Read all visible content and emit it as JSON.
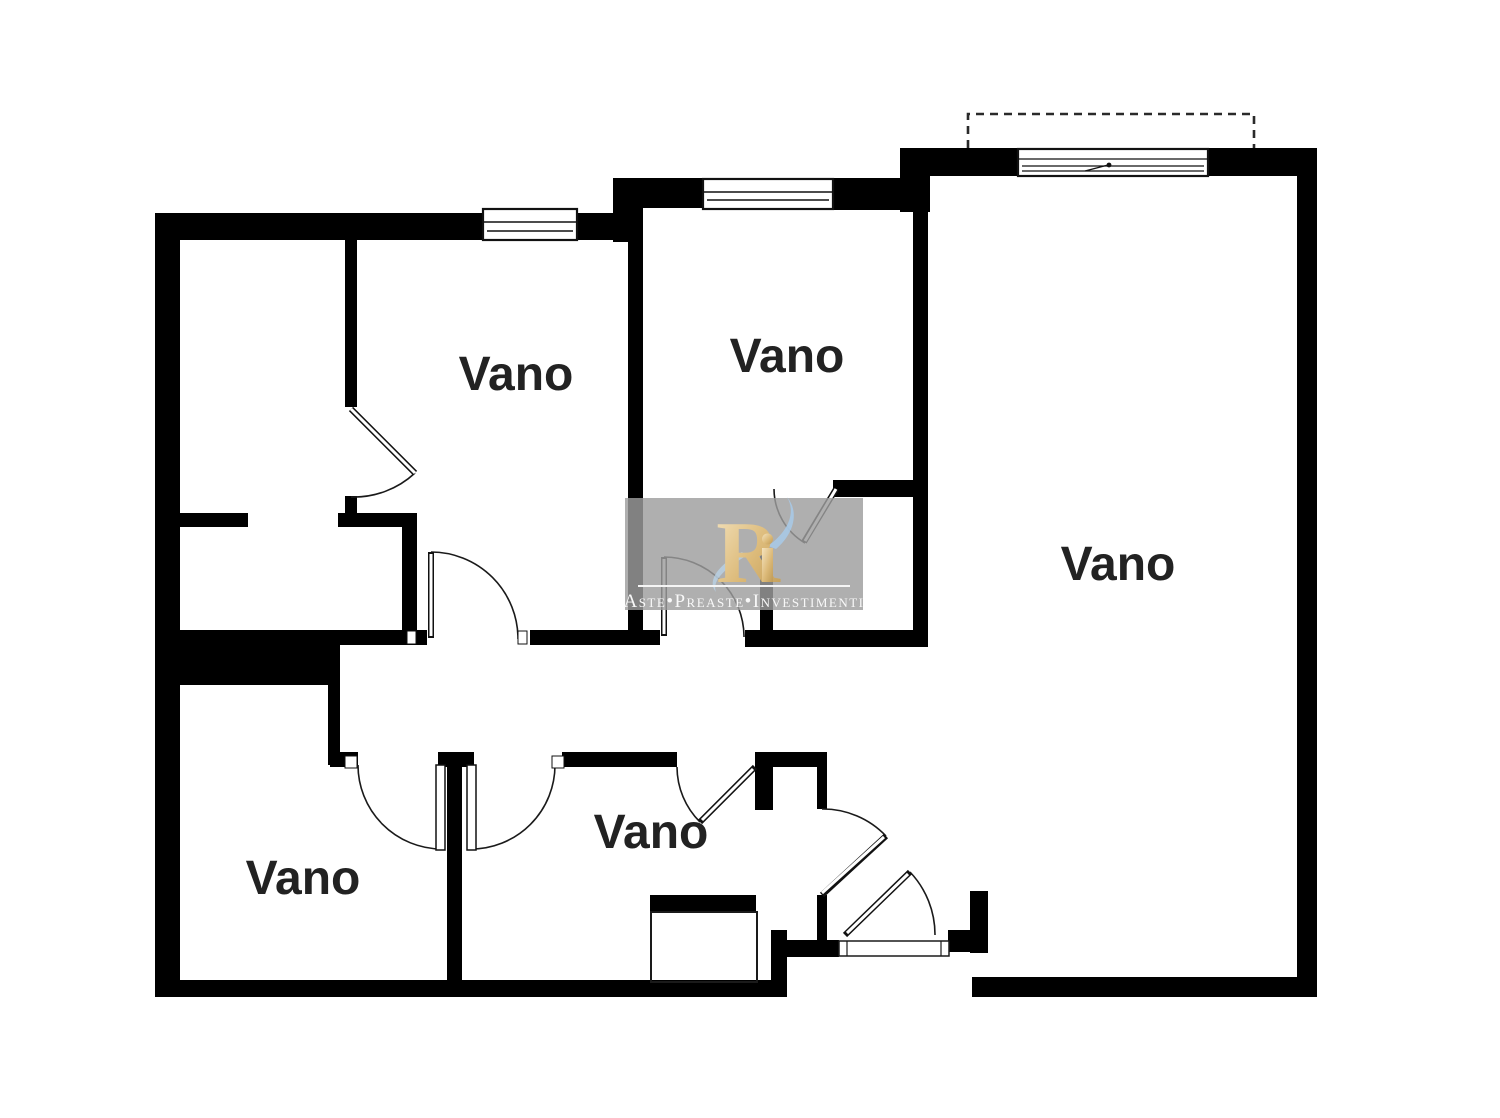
{
  "document": {
    "type": "floor-plan",
    "background": "#ffffff",
    "wall_color": "#000000",
    "label_color": "#222222"
  },
  "rooms": [
    {
      "id": "room-top-left",
      "label": "Vano"
    },
    {
      "id": "room-top-middle",
      "label": "Vano"
    },
    {
      "id": "room-right",
      "label": "Vano"
    },
    {
      "id": "room-bottom-left",
      "label": "Vano"
    },
    {
      "id": "room-bottom-middle",
      "label": "Vano"
    }
  ],
  "watermark": {
    "logo_main": "R",
    "tagline": "Aste•Preaste•Investimenti",
    "colors": {
      "panel": "#9d9d9d",
      "gold_light": "#f0ddb4",
      "gold_dark": "#c9a25e",
      "blue": "#a9c9e6",
      "text": "#f8f8f8"
    }
  }
}
